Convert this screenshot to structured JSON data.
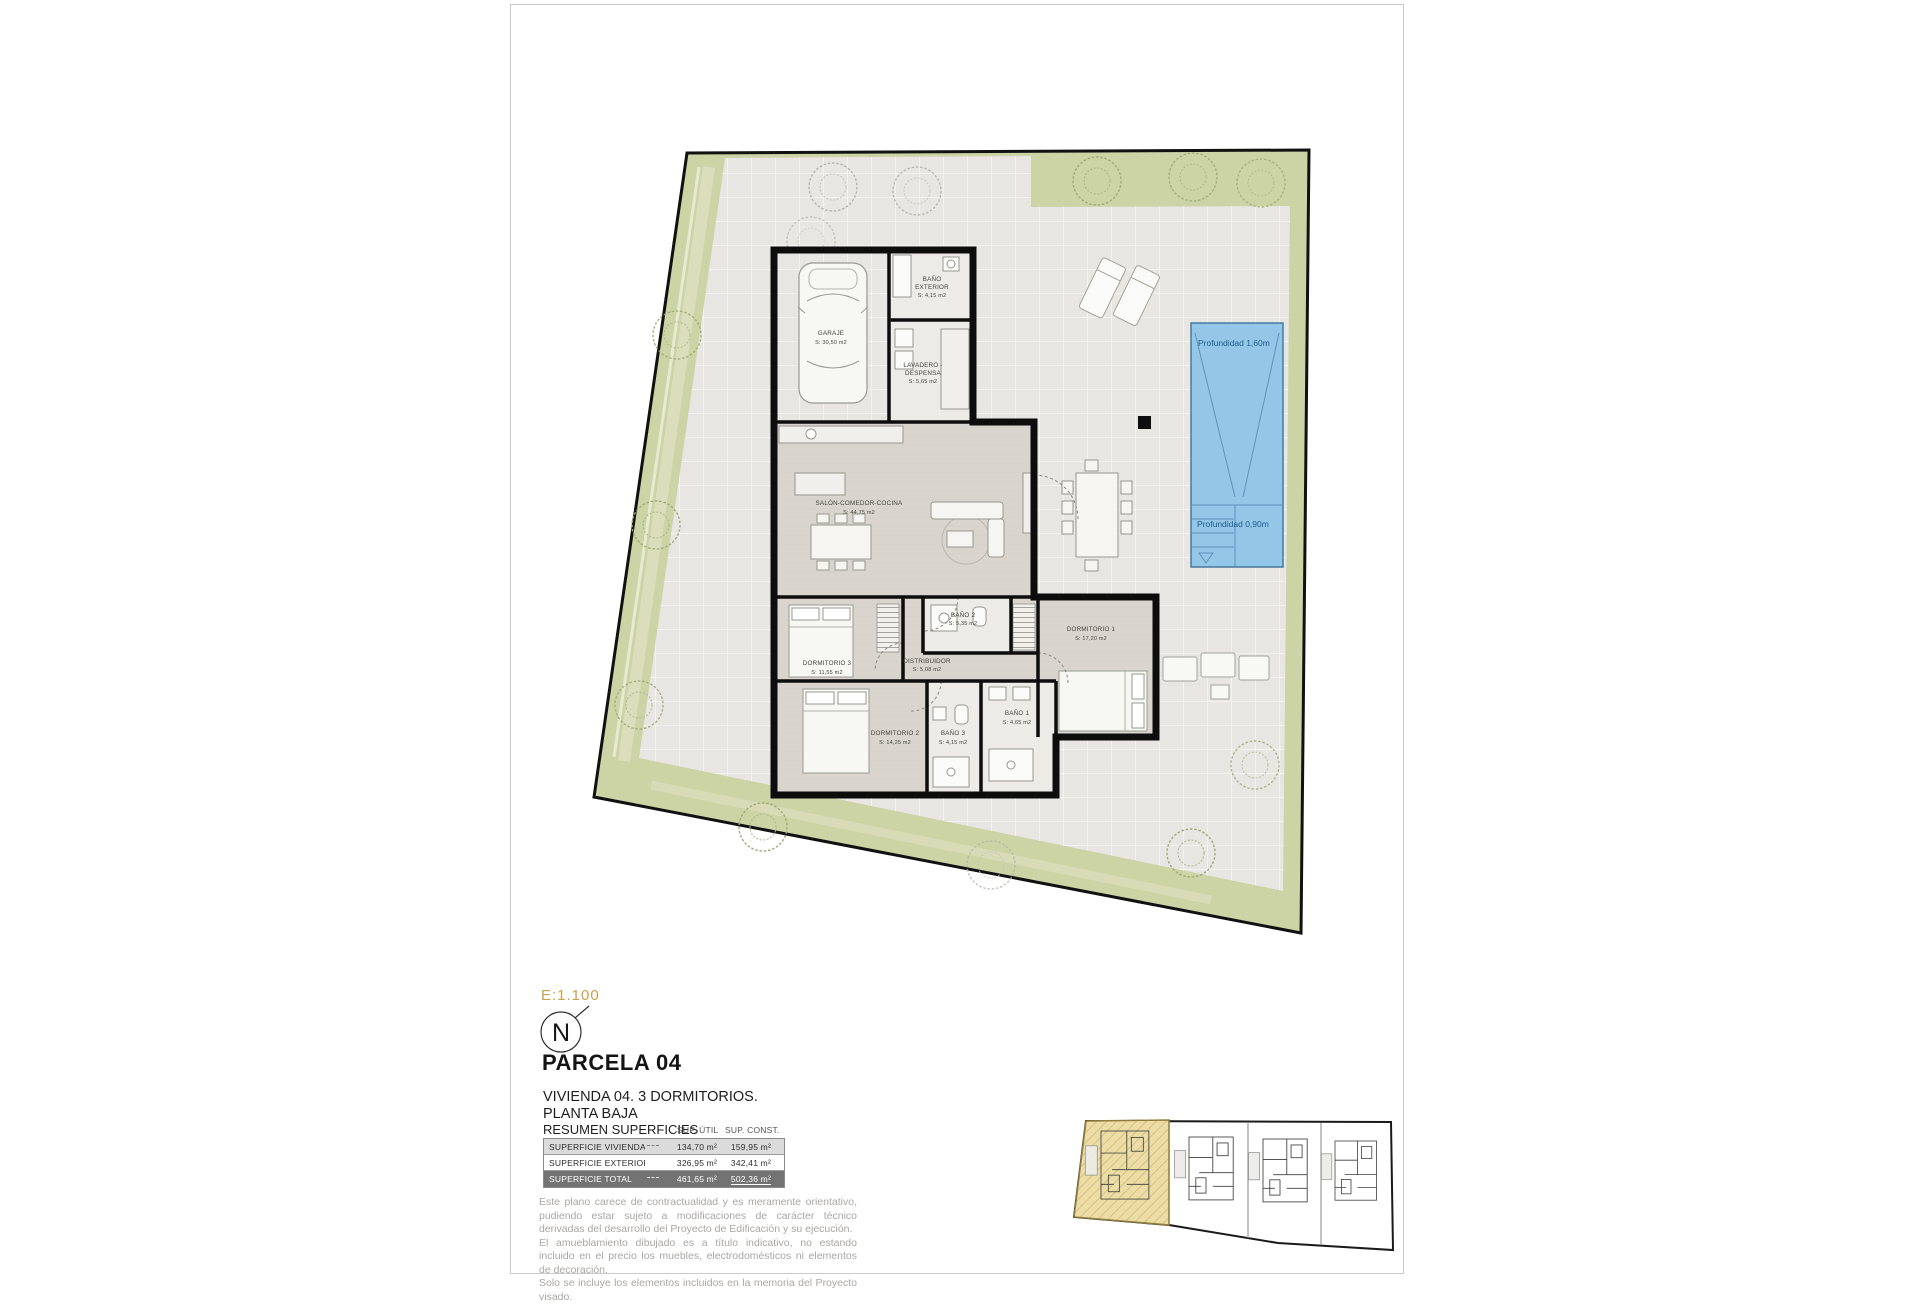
{
  "page": {
    "scale": "E:1.100",
    "north": "N",
    "parcel": "PARCELA 04",
    "subtitle1": "VIVIENDA 04. 3 DORMITORIOS.",
    "subtitle2": "PLANTA BAJA"
  },
  "summary": {
    "title": "RESUMEN SUPERFICIES",
    "col_util": "SUP. ÚTIL",
    "col_const": "SUP. CONST.",
    "rows": [
      {
        "label": "SUPERFICIE VIVIENDA",
        "util": "134,70 m²",
        "const": "159,95 m²"
      },
      {
        "label": "SUPERFICIE EXTERIOR",
        "util": "326,95 m²",
        "const": "342,41 m²"
      },
      {
        "label": "SUPERFICIE TOTAL",
        "util": "461,65 m²",
        "const": "502,36 m²"
      }
    ]
  },
  "disclaimer": {
    "p1": "Este plano carece de contractualidad y es meramente orientativo, pudiendo estar sujeto a modificaciones de carácter técnico derivadas del desarrollo del Proyecto de Edificación y su ejecución.",
    "p2": "El amueblamiento dibujado es a título indicativo, no estando incluido en el precio los muebles, electrodomésticos ni elementos de decoración.",
    "p3": "Solo se incluye los elementos incluidos en la memoria del Proyecto visado."
  },
  "plan": {
    "rooms": {
      "garaje": {
        "name": "GARAJE",
        "area": "S: 30,50 m2"
      },
      "bano_exterior": {
        "name": "BAÑO",
        "name2": "EXTERIOR",
        "area": "S: 4,15 m2"
      },
      "lavadero": {
        "name": "LAVADERO -",
        "name2": "DESPENSA",
        "area": "S: 5,65 m2"
      },
      "salon": {
        "name": "SALÓN-COMEDOR-COCINA",
        "area": "S: 44,75 m2"
      },
      "dormitorio1": {
        "name": "DORMITORIO 1",
        "area": "S: 17,20 m2"
      },
      "dormitorio2": {
        "name": "DORMITORIO 2",
        "area": "S: 14,25 m2"
      },
      "dormitorio3": {
        "name": "DORMITORIO 3",
        "area": "S: 11,55 m2"
      },
      "bano1": {
        "name": "BAÑO 1",
        "area": "S: 4,65 m2"
      },
      "bano2": {
        "name": "BAÑO 2",
        "area": "S: 5,35 m2"
      },
      "bano3": {
        "name": "BAÑO 3",
        "area": "S: 4,15 m2"
      },
      "distribuidor": {
        "name": "DISTRIBUIDOR",
        "area": "S: 5,08 m2"
      }
    },
    "pool": {
      "depth_deep": "Profundidad 1,60m",
      "depth_shallow": "Profundidad 0,90m"
    }
  },
  "colors": {
    "accent_gold": "#c9a24b",
    "grass": "#ccd3a4",
    "paving": "#e7e6e2",
    "pool_fill": "#94c6e8",
    "pool_text": "#1d5a8c",
    "wall": "#0d0d0d",
    "highlight_parcel": "#ecdca6",
    "table_total_bg": "#737373"
  }
}
